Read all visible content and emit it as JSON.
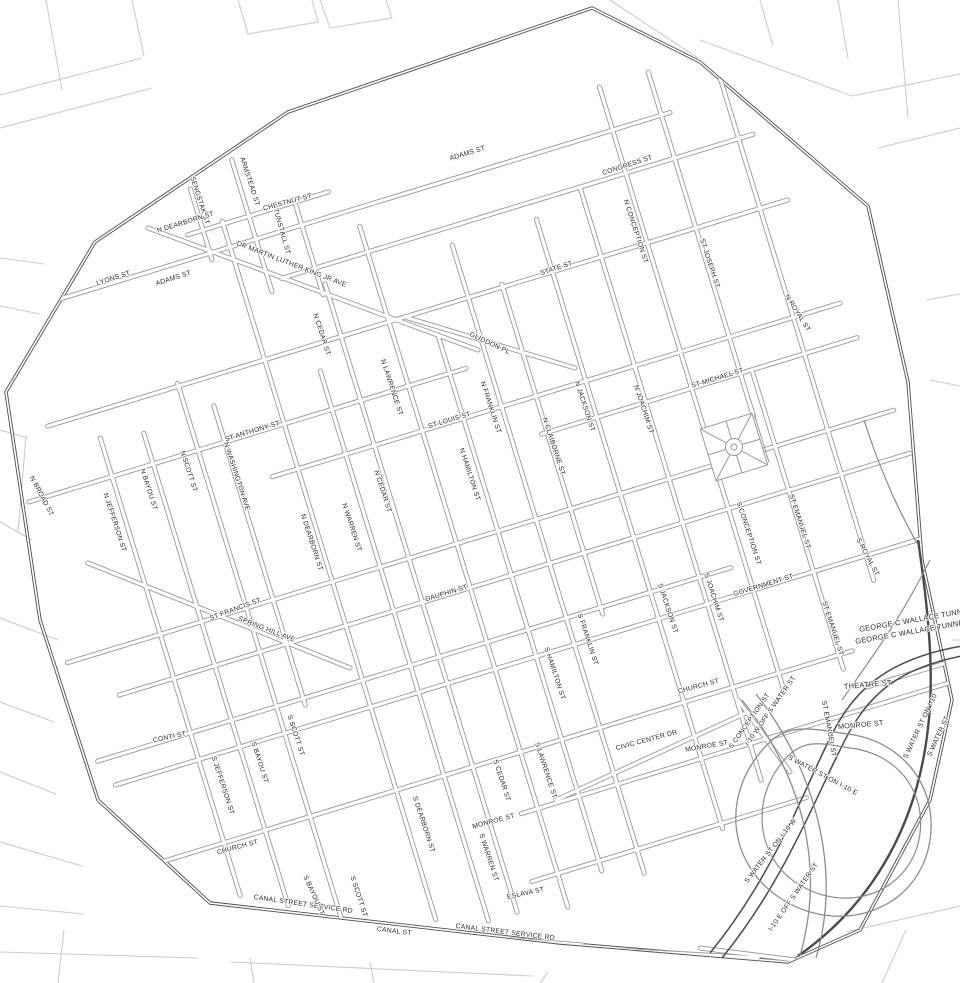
{
  "map": {
    "description": "Downtown street grid map with study-area boundary",
    "colors": {
      "background": "#ffffff",
      "road_casing": "#9a9a9a",
      "road_core": "#ffffff",
      "boundary": "#4d4d4d",
      "highway": "#8c8c8c",
      "highway_dark": "#4a4a4a",
      "context": "#cccccc",
      "label_text": "#2b2b2b"
    },
    "grid": {
      "rotation_deg": -17,
      "center": [
        480,
        500
      ]
    },
    "boundary_points": "6,392 95,242 288,112 592,8 700,62 868,206 908,382 922,560 952,700 930,800 860,930 788,962 560,943 210,903 98,800 40,620",
    "roads_ew": [
      {
        "name": "CHESTNUT ST",
        "v": 161,
        "u1": 278,
        "u2": 425
      },
      {
        "name": "ADAMS ST",
        "v": 185,
        "u1": 100,
        "u2": 775
      },
      {
        "name": "CONGRESS ST",
        "v": 230,
        "u1": 355,
        "u2": 848
      },
      {
        "name": "STATE ST",
        "v": 303,
        "u1": 88,
        "u2": 862
      },
      {
        "name": "ST ANTHONY ST",
        "v": 370,
        "u1": 48,
        "u2": 505
      },
      {
        "name": "ST LOUIS ST",
        "v": 417,
        "u1": 288,
        "u2": 882
      },
      {
        "name": "ST MICHAEL ST",
        "v": 455,
        "u1": 558,
        "u2": 888
      },
      {
        "name": "ST FRANCIS ST",
        "v": 535,
        "u1": 38,
        "u2": 902
      },
      {
        "name": "DAUPHIN ST",
        "v": 581,
        "u1": 78,
        "u2": 905
      },
      {
        "name": "CONTI ST",
        "v": 638,
        "u1": 38,
        "u2": 700
      },
      {
        "name": "GOVERNMENT ST",
        "v": 666,
        "u1": 48,
        "u2": 922
      },
      {
        "name": "CHURCH ST",
        "v": 753,
        "u1": 38,
        "u2": 792
      },
      {
        "name": "MONROE ST",
        "v": 812,
        "u1": 428,
        "u2": 930
      },
      {
        "name": "ESLAVA ST",
        "v": 880,
        "u1": 418,
        "u2": 705
      },
      {
        "name": "THEATRE ST",
        "v": 792,
        "u1": 795,
        "u2": 938
      }
    ],
    "roads_ns": [
      {
        "name": "SENGSTAK ST",
        "u": 294,
        "v1": 118,
        "v2": 192
      },
      {
        "name": "ARMSTEAD ST",
        "u": 342,
        "v1": 102,
        "v2": 240
      },
      {
        "name": "TUNSTALL ST",
        "u": 390,
        "v1": 158,
        "v2": 258
      },
      {
        "name": "N JEFFERSON ST",
        "u": 135,
        "v1": 330,
        "v2": 808
      },
      {
        "name": "N BAYOU ST",
        "u": 178,
        "v1": 338,
        "v2": 832
      },
      {
        "name": "N SCOTT ST",
        "u": 225,
        "v1": 300,
        "v2": 905
      },
      {
        "name": "N WASHINGTON AVE",
        "u": 253,
        "v1": 332,
        "v2": 645
      },
      {
        "name": "N DEARBORN ST",
        "u": 315,
        "v1": 158,
        "v2": 888
      },
      {
        "name": "N WARREN ST",
        "u": 365,
        "v1": 330,
        "v2": 905
      },
      {
        "name": "N CEDAR ST",
        "u": 395,
        "v1": 248,
        "v2": 905
      },
      {
        "name": "N LAWRENCE ST",
        "u": 445,
        "v1": 203,
        "v2": 915
      },
      {
        "name": "N HAMILTON ST",
        "u": 488,
        "v1": 330,
        "v2": 890
      },
      {
        "name": "N FRANKLIN ST",
        "u": 528,
        "v1": 248,
        "v2": 905
      },
      {
        "name": "N CLAIBORNE ST",
        "u": 564,
        "v1": 300,
        "v2": 645
      },
      {
        "name": "N JACKSON ST",
        "u": 616,
        "v1": 248,
        "v2": 885
      },
      {
        "name": "N JOACHIM ST",
        "u": 667,
        "v1": 232,
        "v2": 850
      },
      {
        "name": "N CONCEPTION ST",
        "u": 715,
        "v1": 140,
        "v2": 768
      },
      {
        "name": "ST JOSEPH ST",
        "u": 766,
        "v1": 140,
        "v2": 500
      },
      {
        "name": "ST EMANUEL ST",
        "u": 778,
        "v1": 458,
        "v2": 768
      },
      {
        "name": "N ROYAL ST",
        "u": 833,
        "v1": 148,
        "v2": 692
      }
    ],
    "roads_free": [
      {
        "name": "DR MARTIN LUTHER KING JR AVE",
        "x1": 148,
        "y1": 228,
        "x2": 478,
        "y2": 350
      },
      {
        "name": "GLIDDON PL",
        "x1": 408,
        "y1": 318,
        "x2": 575,
        "y2": 368
      },
      {
        "name": "SPRING HILL AVE",
        "x1": 88,
        "y1": 563,
        "x2": 350,
        "y2": 668
      },
      {
        "name": "CIVIC CENTER DR",
        "x1": 556,
        "y1": 800,
        "x2": 748,
        "y2": 712
      },
      {
        "name": "S CONCEPTION ST",
        "x1": 738,
        "y1": 700,
        "x2": 790,
        "y2": 772
      },
      {
        "name": "CANAL STREET SERVICE RD",
        "x1": 102,
        "y1": 908,
        "x2": 582,
        "y2": 945
      },
      {
        "name": "CANAL ST",
        "x1": 86,
        "y1": 920,
        "x2": 758,
        "y2": 958
      },
      {
        "name": "CANAL STREET SERVICE RD",
        "x1": 700,
        "y1": 948,
        "x2": 930,
        "y2": 977
      }
    ],
    "highways": [
      {
        "name": "s-water-st",
        "d": "M 918,540 C 930,620 934,680 928,728 C 918,818 878,900 798,956",
        "tone": "dark",
        "w": 2.4
      },
      {
        "name": "george-c-wallace-tunnel",
        "d": "M 710,953 C 770,880 800,800 828,742 C 850,696 880,660 962,646",
        "tone": "dark",
        "w": 1.5
      },
      {
        "name": "george-c-wallace-tunnel",
        "d": "M 722,958 C 782,884 812,806 840,750 C 862,704 888,670 962,656",
        "tone": "dark",
        "w": 1.5
      },
      {
        "name": "i10-loop-outer",
        "d": "M 770,742 C 720,790 726,862 780,898 C 838,936 912,912 928,850 C 942,794 908,742 848,734 C 818,730 790,722 770,742 Z",
        "tone": "mid",
        "w": 1.3
      },
      {
        "name": "i10-loop-inner",
        "d": "M 788,756 C 750,794 754,856 798,884 C 846,914 904,894 918,844 C 930,796 900,754 850,748 C 824,744 806,738 788,756 Z",
        "tone": "mid",
        "w": 1.2
      },
      {
        "name": "i10-ramp",
        "d": "M 742,700 C 790,760 830,850 800,956",
        "tone": "mid",
        "w": 1.3
      },
      {
        "name": "i10-ramp",
        "d": "M 756,694 C 804,754 846,856 816,958",
        "tone": "mid",
        "w": 1.3
      },
      {
        "name": "water-st-ramp",
        "d": "M 930,560 C 900,620 870,660 842,700",
        "tone": "mid",
        "w": 1.2
      },
      {
        "name": "water-st-upper",
        "d": "M 864,420 C 880,470 898,510 918,545",
        "tone": "mid",
        "w": 1.2
      }
    ],
    "labels": [
      {
        "t": "ADAMS ST",
        "x": 468,
        "y": 155,
        "r": -17
      },
      {
        "t": "CONGRESS ST",
        "x": 628,
        "y": 167,
        "r": -18
      },
      {
        "t": "N CONCEPTION ST",
        "x": 634,
        "y": 232,
        "r": 72
      },
      {
        "t": "STATE ST",
        "x": 557,
        "y": 270,
        "r": -18
      },
      {
        "t": "ST JOSEPH ST",
        "x": 708,
        "y": 264,
        "r": 72
      },
      {
        "t": "N ROYAL ST",
        "x": 796,
        "y": 314,
        "r": 58
      },
      {
        "t": "SENGSTAK ST",
        "x": 198,
        "y": 201,
        "r": 72
      },
      {
        "t": "N DEARBORN ST",
        "x": 186,
        "y": 224,
        "r": -17
      },
      {
        "t": "ARMSTEAD ST",
        "x": 248,
        "y": 182,
        "r": 72
      },
      {
        "t": "CHESTNUT ST",
        "x": 288,
        "y": 204,
        "r": -15
      },
      {
        "t": "TUNSTALL ST",
        "x": 280,
        "y": 232,
        "r": 74
      },
      {
        "t": "DR MARTIN LUTHER KING JR AVE",
        "x": 291,
        "y": 266,
        "r": 21
      },
      {
        "t": "LYONS ST",
        "x": 114,
        "y": 280,
        "r": -18
      },
      {
        "t": "ADAMS ST",
        "x": 174,
        "y": 280,
        "r": -18
      },
      {
        "t": "N CEDAR ST",
        "x": 320,
        "y": 335,
        "r": 72
      },
      {
        "t": "GLIDDON PL",
        "x": 489,
        "y": 345,
        "r": 25
      },
      {
        "t": "N LAWRENCE ST",
        "x": 390,
        "y": 388,
        "r": 72
      },
      {
        "t": "ST LOUIS ST",
        "x": 450,
        "y": 422,
        "r": -17
      },
      {
        "t": "N FRANKLIN ST",
        "x": 489,
        "y": 408,
        "r": 72
      },
      {
        "t": "N HAMILTON ST",
        "x": 468,
        "y": 475,
        "r": 72
      },
      {
        "t": "N CLAIBORNE ST",
        "x": 552,
        "y": 447,
        "r": 72
      },
      {
        "t": "N JACKSON ST",
        "x": 583,
        "y": 407,
        "r": 72
      },
      {
        "t": "N JOACHIM ST",
        "x": 642,
        "y": 410,
        "r": 72
      },
      {
        "t": "ST MICHAEL ST",
        "x": 718,
        "y": 380,
        "r": -17
      },
      {
        "t": "N WASHINGTON AVE",
        "x": 235,
        "y": 477,
        "r": 72
      },
      {
        "t": "ST ANTHONY ST",
        "x": 253,
        "y": 433,
        "r": -17
      },
      {
        "t": "N SCOTT ST",
        "x": 187,
        "y": 472,
        "r": 72
      },
      {
        "t": "N BAYOU ST",
        "x": 147,
        "y": 490,
        "r": 72
      },
      {
        "t": "N JEFFERSON ST",
        "x": 113,
        "y": 523,
        "r": 72
      },
      {
        "t": "N BROAD ST",
        "x": 40,
        "y": 497,
        "r": 62
      },
      {
        "t": "N DEARBORN ST",
        "x": 310,
        "y": 543,
        "r": 72
      },
      {
        "t": "N WARREN ST",
        "x": 350,
        "y": 528,
        "r": 72
      },
      {
        "t": "N CEDAR ST",
        "x": 381,
        "y": 492,
        "r": 72
      },
      {
        "t": "S CONCEPTION ST",
        "x": 747,
        "y": 534,
        "r": 72
      },
      {
        "t": "ST EMANUEL ST",
        "x": 798,
        "y": 522,
        "r": 72
      },
      {
        "t": "S ROYAL ST",
        "x": 866,
        "y": 558,
        "r": 62
      },
      {
        "t": "GOVERNMENT ST",
        "x": 764,
        "y": 587,
        "r": -17
      },
      {
        "t": "ST FRANCIS ST",
        "x": 236,
        "y": 611,
        "r": -20
      },
      {
        "t": "SPRING HILL AVE",
        "x": 266,
        "y": 631,
        "r": 21
      },
      {
        "t": "DAUPHIN ST",
        "x": 447,
        "y": 595,
        "r": -17
      },
      {
        "t": "S FRANKLIN ST",
        "x": 586,
        "y": 640,
        "r": 72
      },
      {
        "t": "S HAMILTON ST",
        "x": 553,
        "y": 674,
        "r": 72
      },
      {
        "t": "S JACKSON ST",
        "x": 666,
        "y": 609,
        "r": 72
      },
      {
        "t": "S JOACHIM ST",
        "x": 712,
        "y": 598,
        "r": 72
      },
      {
        "t": "CHURCH ST",
        "x": 699,
        "y": 688,
        "r": -15
      },
      {
        "t": "ST EMANUEL ST",
        "x": 831,
        "y": 629,
        "r": 72
      },
      {
        "t": "GEORGE C WALLACE TUNNEL",
        "x": 916,
        "y": 622,
        "r": -10,
        "fs": 7.4
      },
      {
        "t": "GEORGE C WALLACE TUNNEL",
        "x": 912,
        "y": 634,
        "r": -10,
        "fs": 7.4
      },
      {
        "t": "THEATRE ST",
        "x": 868,
        "y": 687,
        "r": -5,
        "fs": 7.4
      },
      {
        "t": "MONROE ST",
        "x": 861,
        "y": 727,
        "r": -5,
        "fs": 7.2
      },
      {
        "t": "ST EMANUEL ST",
        "x": 827,
        "y": 729,
        "r": 80
      },
      {
        "t": "S WATER ST ON I-10",
        "x": 922,
        "y": 727,
        "r": -65
      },
      {
        "t": "S WATER ST",
        "x": 940,
        "y": 737,
        "r": -65
      },
      {
        "t": "I-10 W OFF S WATER ST",
        "x": 772,
        "y": 712,
        "r": -55
      },
      {
        "t": "S CONCEPTION ST",
        "x": 751,
        "y": 722,
        "r": -55
      },
      {
        "t": "CIVIC CENTER DR",
        "x": 647,
        "y": 742,
        "r": -15
      },
      {
        "t": "MONROE ST",
        "x": 707,
        "y": 748,
        "r": -10
      },
      {
        "t": "S WATER ST ON I-10 E",
        "x": 822,
        "y": 777,
        "r": 28
      },
      {
        "t": "S WATER ST ON I-10 W",
        "x": 772,
        "y": 852,
        "r": -52
      },
      {
        "t": "I-10 E OFF S WATER ST",
        "x": 795,
        "y": 898,
        "r": -55
      },
      {
        "t": "CONTI ST",
        "x": 170,
        "y": 739,
        "r": -12
      },
      {
        "t": "S JEFFERSON ST",
        "x": 221,
        "y": 786,
        "r": 72
      },
      {
        "t": "S BAYOU ST",
        "x": 258,
        "y": 763,
        "r": 72
      },
      {
        "t": "S SCOTT ST",
        "x": 294,
        "y": 736,
        "r": 72
      },
      {
        "t": "CHURCH ST",
        "x": 238,
        "y": 849,
        "r": -15
      },
      {
        "t": "S DEARBORN ST",
        "x": 422,
        "y": 825,
        "r": 72
      },
      {
        "t": "S CEDAR ST",
        "x": 500,
        "y": 781,
        "r": 72
      },
      {
        "t": "S LAWRENCE ST",
        "x": 544,
        "y": 771,
        "r": 72
      },
      {
        "t": "MONROE ST",
        "x": 494,
        "y": 823,
        "r": -15
      },
      {
        "t": "S WARREN ST",
        "x": 487,
        "y": 858,
        "r": 72
      },
      {
        "t": "ESLAVA ST",
        "x": 526,
        "y": 895,
        "r": -12
      },
      {
        "t": "CANAL STREET SERVICE RD",
        "x": 303,
        "y": 906,
        "r": 8
      },
      {
        "t": "S BAYOU ST",
        "x": 312,
        "y": 896,
        "r": 66
      },
      {
        "t": "S SCOTT ST",
        "x": 357,
        "y": 897,
        "r": 72
      },
      {
        "t": "CANAL ST",
        "x": 394,
        "y": 933,
        "r": 7
      },
      {
        "t": "CANAL STREET SERVICE RD",
        "x": 505,
        "y": 934,
        "r": 7
      }
    ]
  }
}
